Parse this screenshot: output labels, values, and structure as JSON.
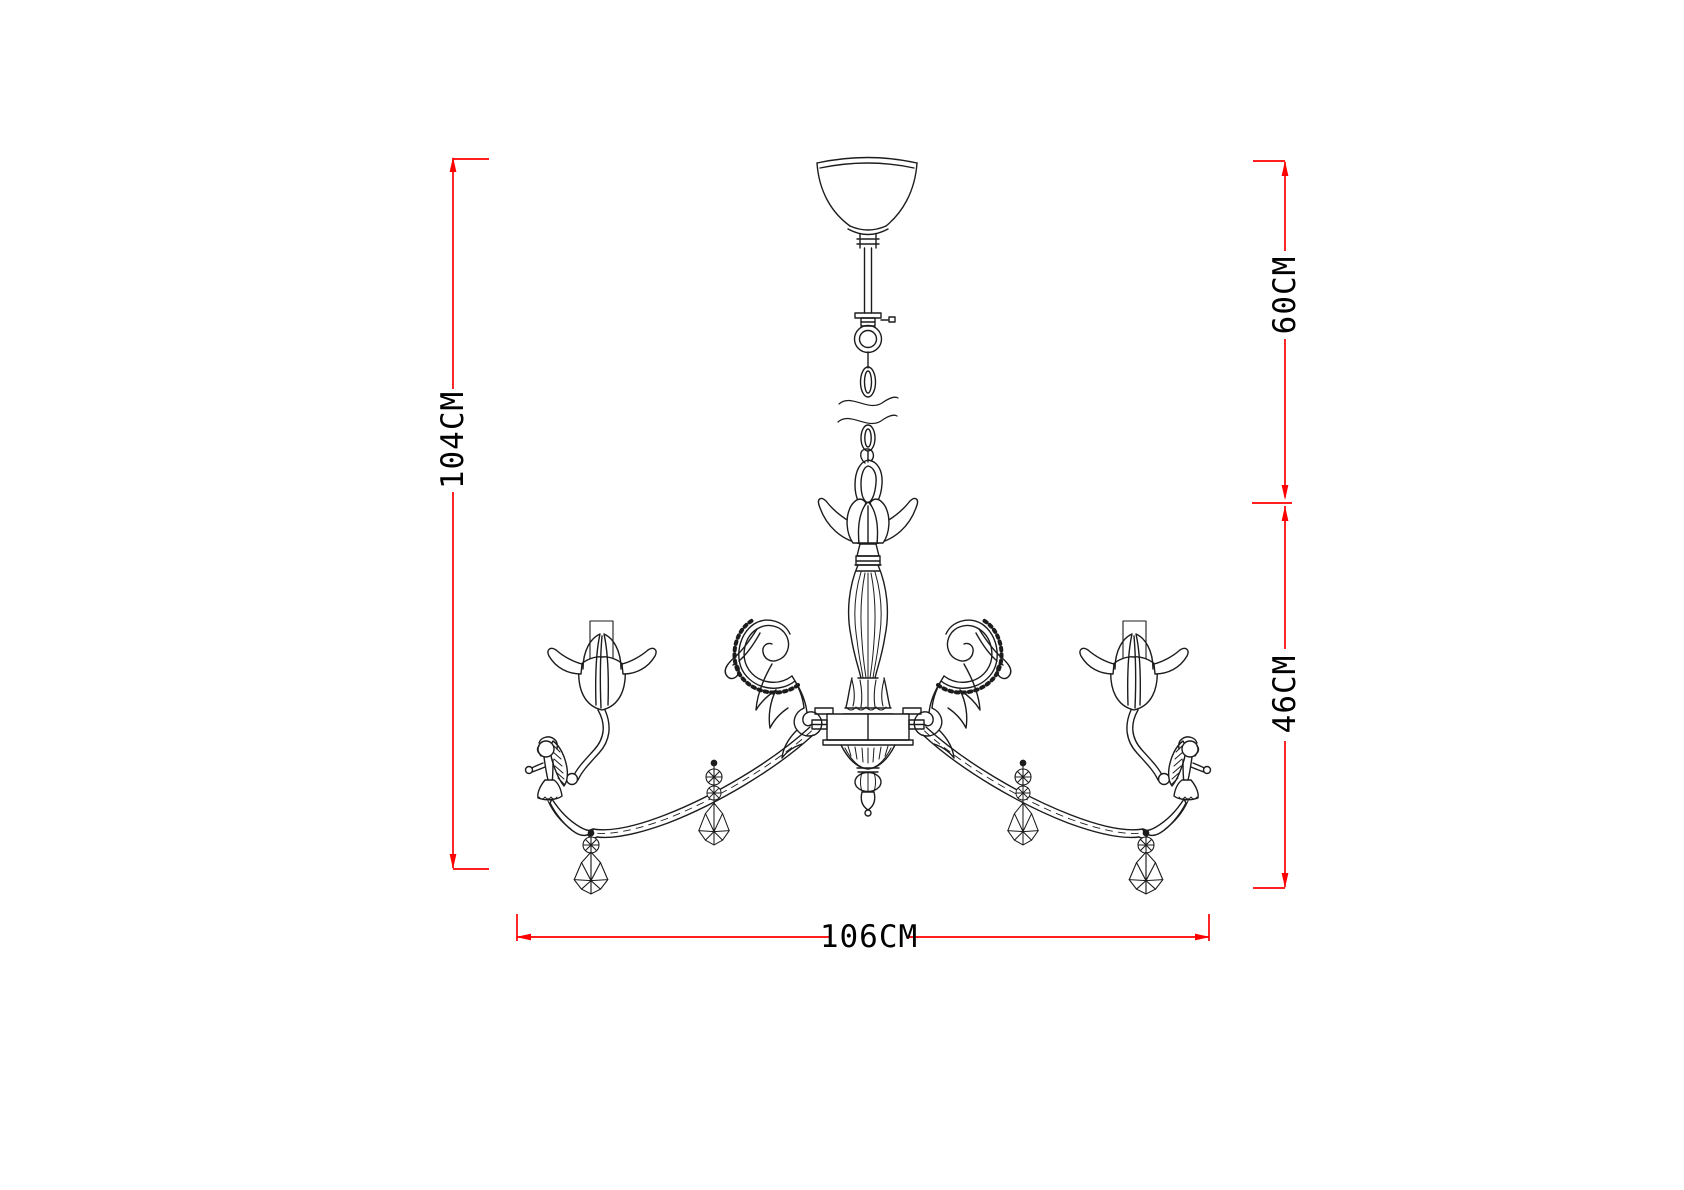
{
  "page": {
    "background": "#ffffff"
  },
  "drawing": {
    "subject": "chandelier-technical-line-drawing",
    "line_color": "#1c1c1c",
    "dimension_color": "#fe0000",
    "label_color": "#000000"
  },
  "dimensions": {
    "overall_height": "104CM",
    "suspension_height": "60CM",
    "body_height": "46CM",
    "overall_width": "106CM"
  }
}
